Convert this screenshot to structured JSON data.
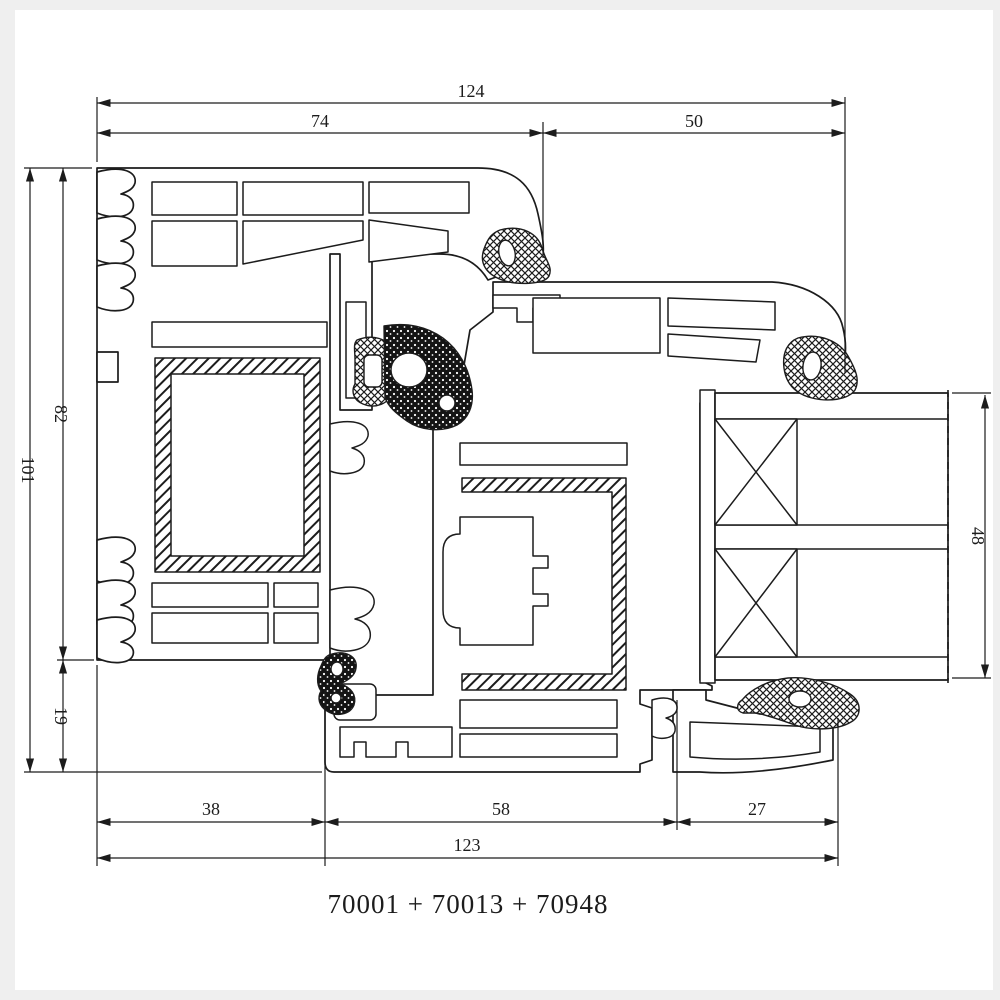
{
  "page": {
    "background_color": "#efefef",
    "canvas_color": "#ffffff",
    "line_color": "#1c1c1c"
  },
  "drawing": {
    "type": "window-profile-cross-section",
    "caption": "70001 + 70013 + 70948",
    "profile_codes": [
      "70001",
      "70013",
      "70948"
    ],
    "dimensions": {
      "top_total": "124",
      "top_left": "74",
      "top_right": "50",
      "left_total": "101",
      "left_upper": "82",
      "left_lower": "19",
      "right_glazing": "48",
      "bottom_left": "38",
      "bottom_middle": "58",
      "bottom_right": "27",
      "bottom_total": "123"
    }
  }
}
